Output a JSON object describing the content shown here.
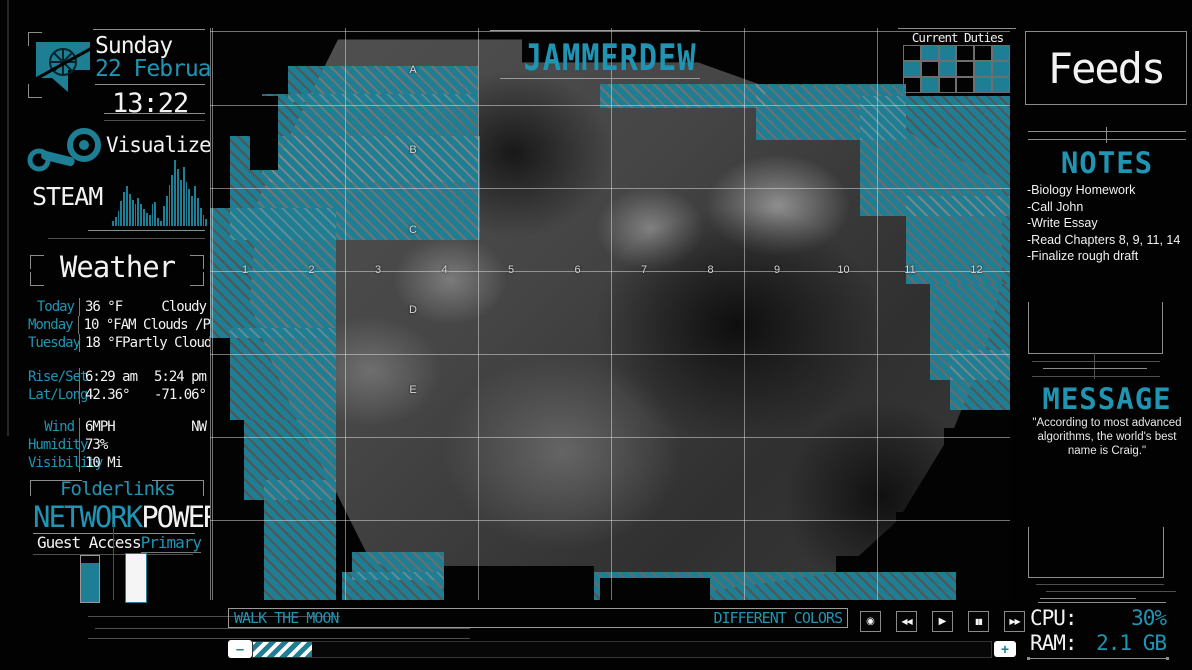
{
  "colors": {
    "accent": "#2095b3",
    "accent_fill": "#1d7e94",
    "white": "#f2f2f2",
    "line_gray": "#8c8c8c"
  },
  "clock": {
    "day": "Sunday",
    "date": "22 February",
    "time": "13:22"
  },
  "twitch": {
    "label": "twitch"
  },
  "steam": {
    "title": "Visualizer",
    "label": "STEAM",
    "bars": [
      8,
      14,
      22,
      38,
      52,
      60,
      48,
      40,
      34,
      42,
      34,
      26,
      20,
      16,
      34,
      36,
      12,
      8,
      30,
      46,
      62,
      78,
      100,
      86,
      70,
      90,
      66,
      56,
      46,
      60,
      42,
      28,
      16,
      10
    ]
  },
  "weather": {
    "title": "Weather",
    "forecast": [
      {
        "day": "Today",
        "temp": "36 °F",
        "desc": "Cloudy"
      },
      {
        "day": "Monday",
        "temp": "10 °F",
        "desc": "AM Clouds /PM Sun"
      },
      {
        "day": "Tuesday",
        "temp": "18 °F",
        "desc": "Partly Cloudy"
      }
    ],
    "astro": [
      {
        "label": "Rise/Set",
        "v1": "6:29 am",
        "v2": "5:24 pm"
      },
      {
        "label": "Lat/Long",
        "v1": "42.36°",
        "v2": "-71.06°"
      }
    ],
    "conditions": [
      {
        "label": "Wind",
        "v1": "6MPH",
        "v2": "NW"
      },
      {
        "label": "Humidity",
        "v1": "73%",
        "v2": ""
      },
      {
        "label": "Visibility",
        "v1": "10 Mi",
        "v2": ""
      }
    ]
  },
  "folderlinks": {
    "title": "Folderlinks"
  },
  "network": {
    "title": "NETWORK",
    "subtitle": "Guest Access",
    "level_pct": 84
  },
  "power": {
    "title": "POWER",
    "subtitle": "Primary",
    "level_pct": 100
  },
  "applinks": [
    {
      "label": "Skype",
      "accent": true
    },
    {
      "label": "Netflix",
      "accent": false
    },
    {
      "label": "RollPlay",
      "accent": true
    },
    {
      "label": "Chrome",
      "accent": false
    },
    {
      "label": "Youtube",
      "accent": true
    },
    {
      "label": "Desktop",
      "accent": false
    },
    {
      "label": "Paint.net",
      "accent": true
    },
    {
      "label": "Rainmeter",
      "accent": false
    },
    {
      "label": "Downloads",
      "accent": true
    }
  ],
  "map": {
    "title": "JAMMERDEW",
    "col_labels": [
      "1",
      "2",
      "3",
      "4",
      "5",
      "6",
      "7",
      "8",
      "9",
      "10",
      "11",
      "12"
    ],
    "row_labels": [
      "A",
      "B",
      "C",
      "D",
      "E"
    ]
  },
  "duties": {
    "title": "Current Duties",
    "grid": [
      [
        0,
        1,
        1,
        0,
        0,
        1
      ],
      [
        1,
        0,
        1,
        0,
        1,
        1
      ],
      [
        0,
        1,
        0,
        0,
        1,
        1
      ]
    ]
  },
  "feeds": {
    "title": "Feeds"
  },
  "notes": {
    "title": "NOTES",
    "items": [
      "-Biology Homework",
      "-Call John",
      "-Write Essay",
      "-Read Chapters 8, 9, 11, 14",
      "-Finalize rough draft"
    ]
  },
  "message": {
    "title": "MESSAGE",
    "text": "\"According to most advanced algorithms, the world's best name is Craig.\""
  },
  "player": {
    "artist": "WALK THE MOON",
    "track": "DIFFERENT COLORS",
    "minus": "–",
    "plus": "+",
    "progress_pct": 8,
    "buttons": [
      {
        "name": "record",
        "glyph": "◉"
      },
      {
        "name": "rewind",
        "glyph": "◀◀"
      },
      {
        "name": "play",
        "glyph": "▶"
      },
      {
        "name": "pause",
        "glyph": "▮▮"
      },
      {
        "name": "fast-forward",
        "glyph": "▶▶"
      }
    ]
  },
  "system": {
    "cpu_label": "CPU:",
    "cpu_value": "30%",
    "ram_label": "RAM:",
    "ram_value": "2.1 GB"
  }
}
